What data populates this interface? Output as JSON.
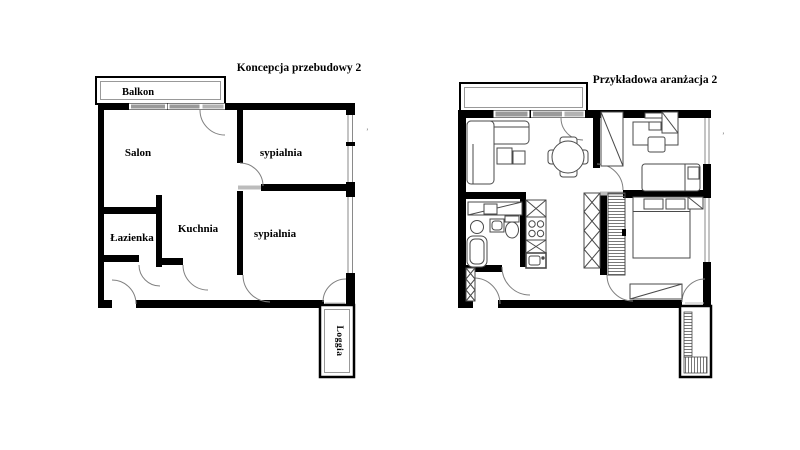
{
  "plan_left": {
    "title": "Koncepcja przebudowy 2",
    "balcony_label": "Balkon",
    "living_room_label": "Salon",
    "bedroom_top_label": "sypialnia",
    "kitchen_label": "Kuchnia",
    "bathroom_label": "Łazienka",
    "bedroom_bottom_label": "sypialnia",
    "loggia_label": "Loggia"
  },
  "plan_right": {
    "title": "Przykładowa aranżacja 2"
  },
  "misc": {
    "stray_mark": "’"
  },
  "colors": {
    "wall": "#000000",
    "window_glass": "#9a9a9a",
    "window_frame": "#8a8a8a",
    "door_threshold": "#bcbcbc",
    "door_arc": "#808080",
    "furniture_line": "#4a4a4a",
    "balcony_inner_border": "#999999",
    "background": "#ffffff"
  }
}
